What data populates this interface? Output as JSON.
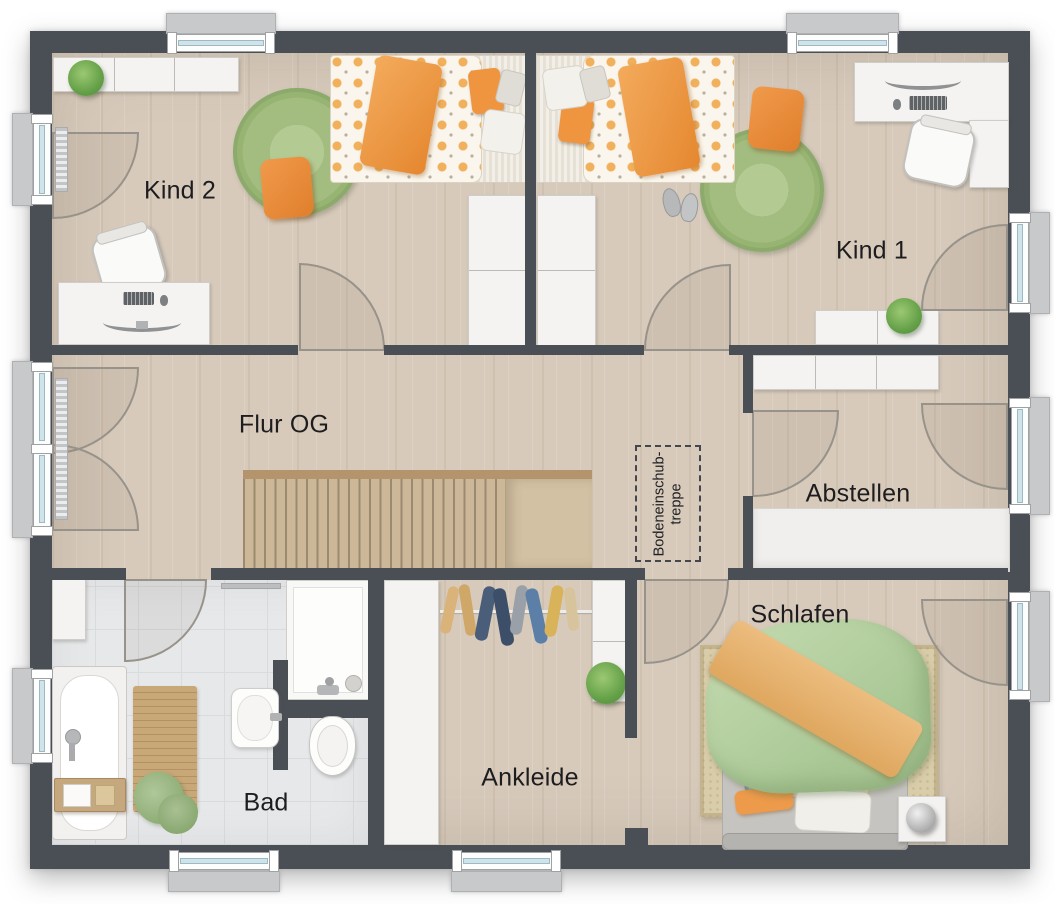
{
  "plan": {
    "type": "floorplan-upper-floor",
    "rooms": [
      {
        "id": "kind2",
        "label": "Kind 2"
      },
      {
        "id": "kind1",
        "label": "Kind 1"
      },
      {
        "id": "flur",
        "label": "Flur OG"
      },
      {
        "id": "abstellen",
        "label": "Abstellen"
      },
      {
        "id": "schlafen",
        "label": "Schlafen"
      },
      {
        "id": "ankleide",
        "label": "Ankleide"
      },
      {
        "id": "bad",
        "label": "Bad"
      }
    ],
    "attic_hatch": {
      "line1": "Bodeneinschub-",
      "line2": "treppe"
    },
    "colors": {
      "wall": "#4a4f55",
      "floor_wood": "#d7cabb",
      "floor_tile": "#e6e8ea",
      "accent_orange": "#ee9440",
      "accent_green": "#a3bd80",
      "furniture_white": "#f4f3f1",
      "stair_wood": "#ccb899",
      "window_glass": "#cfe3ea"
    },
    "windows": [
      {
        "id": "window-kind2-top"
      },
      {
        "id": "window-kind1-top"
      },
      {
        "id": "window-kind2-left-door"
      },
      {
        "id": "window-flur-left-double-door"
      },
      {
        "id": "window-bad-left"
      },
      {
        "id": "window-bad-bottom"
      },
      {
        "id": "window-ankleide-bottom"
      },
      {
        "id": "window-kind1-right-door"
      },
      {
        "id": "window-abstellen-right-door"
      },
      {
        "id": "window-schlafen-right-door"
      }
    ],
    "doors": [
      {
        "id": "door-kind2"
      },
      {
        "id": "door-kind1"
      },
      {
        "id": "door-bad"
      },
      {
        "id": "door-schlafen"
      },
      {
        "id": "door-abstellen"
      }
    ],
    "furniture": [
      {
        "room": "kind2",
        "items": [
          "wall-shelf",
          "potted-plant",
          "single-bed",
          "round-rug",
          "floor-cushion",
          "desk",
          "desk-chair",
          "pc-monitor",
          "keyboard",
          "wardrobe"
        ]
      },
      {
        "room": "kind1",
        "items": [
          "single-bed",
          "slippers",
          "round-rug",
          "floor-cushion",
          "corner-desk",
          "desk-chair",
          "pc-monitor",
          "keyboard",
          "sideboard",
          "potted-plant",
          "wardrobe"
        ]
      },
      {
        "room": "flur",
        "items": [
          "staircase",
          "attic-hatch"
        ]
      },
      {
        "room": "abstellen",
        "items": [
          "upper-cabinets",
          "storage-cabinet"
        ]
      },
      {
        "room": "bad",
        "items": [
          "bathtub",
          "bath-caddy",
          "wall-cabinet",
          "towel-rail",
          "bath-mat",
          "towels",
          "washbasin",
          "shower",
          "toilet"
        ]
      },
      {
        "room": "ankleide",
        "items": [
          "wardrobe",
          "clothes-rail",
          "hanging-clothes",
          "shelf-column",
          "potted-plant"
        ]
      },
      {
        "room": "schlafen",
        "items": [
          "double-bed",
          "duvet",
          "throw-blanket",
          "pillows",
          "area-rug",
          "nightstand",
          "ball-lamp"
        ]
      }
    ]
  }
}
